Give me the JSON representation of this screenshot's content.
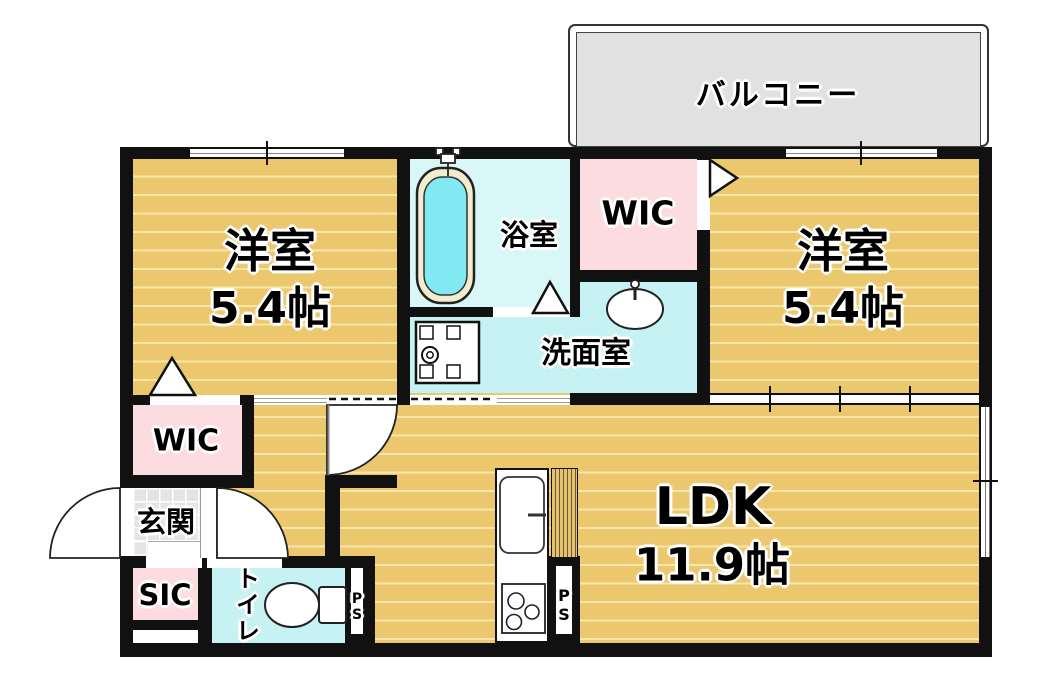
{
  "floorplan": {
    "title": "1LDK-apartment-floor-plan",
    "balcony": {
      "label": "バルコニー"
    },
    "bedroom_left": {
      "label": "洋室",
      "size": "5.4帖"
    },
    "bedroom_right": {
      "label": "洋室",
      "size": "5.4帖"
    },
    "bathroom": {
      "label": "浴室"
    },
    "wic_right": {
      "label": "WIC"
    },
    "washroom": {
      "label": "洗面室"
    },
    "wic_left": {
      "label": "WIC"
    },
    "entrance": {
      "label": "玄関"
    },
    "sic": {
      "label": "SIC"
    },
    "toilet": {
      "label": "トイレ"
    },
    "ps_left": {
      "label": "PS"
    },
    "ps_right": {
      "label": "PS"
    },
    "ldk": {
      "label": "LDK",
      "size": "11.9帖"
    },
    "colors": {
      "wood_floor": "#ebc76e",
      "wood_line": "#f7e5ab",
      "closet_pink": "#fcdce0",
      "wet_cyan": "#c7f2f4",
      "bathroom_cyan": "#daf7f7",
      "tub_water": "#80e9f1",
      "tub_rim": "#f3edcf",
      "entrance_tile": "#e4e4e4",
      "balcony_gray": "#e1e1e1",
      "wall_black": "#111111"
    }
  }
}
